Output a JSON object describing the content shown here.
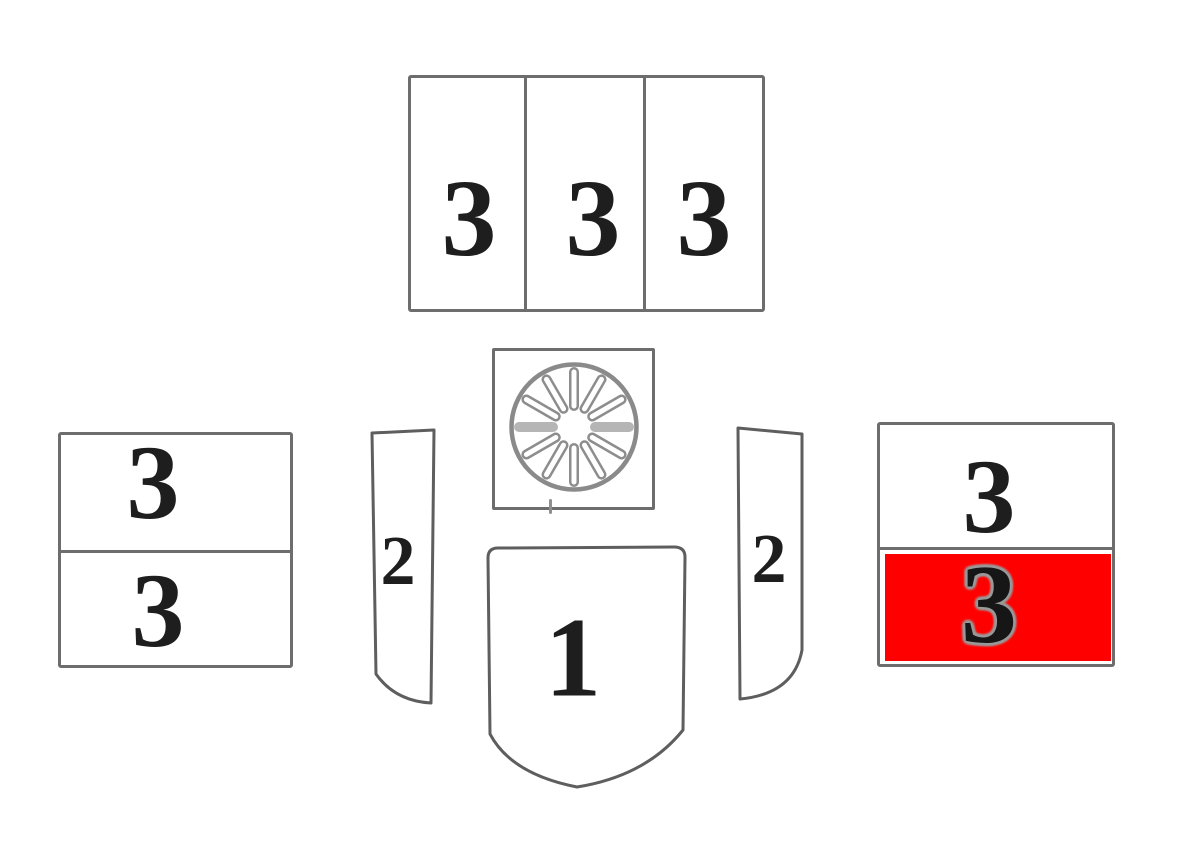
{
  "colors": {
    "background": "#ffffff",
    "outline": "#6d6d6d",
    "digit": "#1e1e1e",
    "highlight": "#ff0000"
  },
  "parts": {
    "top_row": {
      "labels": [
        "3",
        "3",
        "3"
      ]
    },
    "rosette": {
      "slot_count": 12
    },
    "left_stack": {
      "top_label": "3",
      "bottom_label": "3"
    },
    "left_rail": {
      "label": "2"
    },
    "front_shield": {
      "label": "1"
    },
    "right_rail": {
      "label": "2"
    },
    "right_stack": {
      "top_label": "3",
      "bottom_label": "3",
      "bottom_highlighted": true
    }
  }
}
